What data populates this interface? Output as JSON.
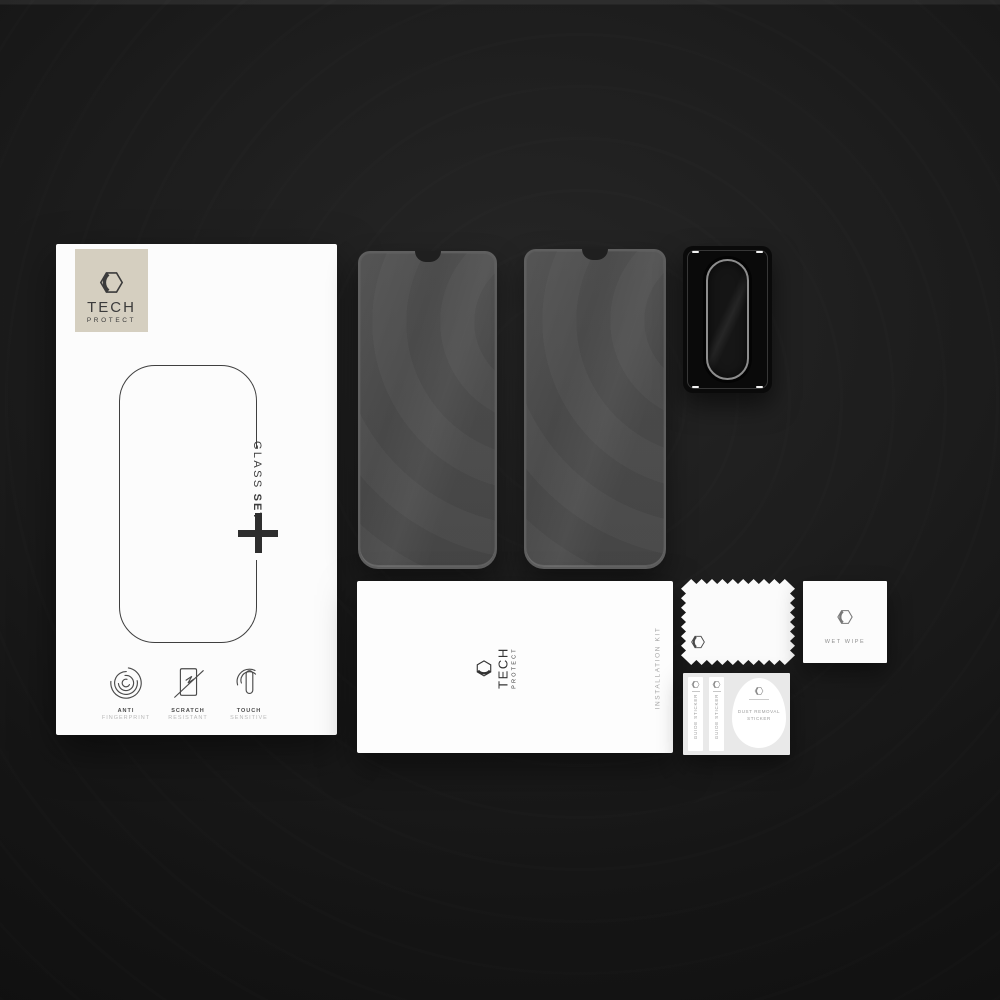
{
  "colors": {
    "background": "#1c1c1c",
    "box_white": "#fcfcfc",
    "logo_beige": "#d5cfc0",
    "glass_gray": "#4b4b4b",
    "frame_black": "#0a0a0a",
    "card_gray": "#e9e9e9",
    "ink_dark": "#3b3b3b",
    "ink_light": "#a6a6a6"
  },
  "brand": {
    "name": "TECH",
    "sub": "PROTECT",
    "logo_icon": "hexagon-logo-icon"
  },
  "retail_box": {
    "product_name": "GLASS",
    "product_variant": "SET",
    "plus_icon": "plus-icon",
    "features": [
      {
        "icon": "fingerprint-icon",
        "title": "ANTI",
        "subtitle": "FINGERPRINT"
      },
      {
        "icon": "scratch-icon",
        "title": "SCRATCH",
        "subtitle": "RESISTANT"
      },
      {
        "icon": "touch-icon",
        "title": "TOUCH",
        "subtitle": "SENSITIVE"
      }
    ]
  },
  "glass_protectors": {
    "count": 2
  },
  "installation_kit": {
    "label": "INSTALLATION KIT"
  },
  "accessories": {
    "wet_wipe": {
      "label": "WET WIPE"
    },
    "guide_stickers": [
      {
        "label": "GUIDE STICKER"
      },
      {
        "label": "GUIDE STICKER"
      }
    ],
    "dust_sticker": {
      "label_line1": "DUST REMOVAL",
      "label_line2": "STICKER"
    }
  }
}
